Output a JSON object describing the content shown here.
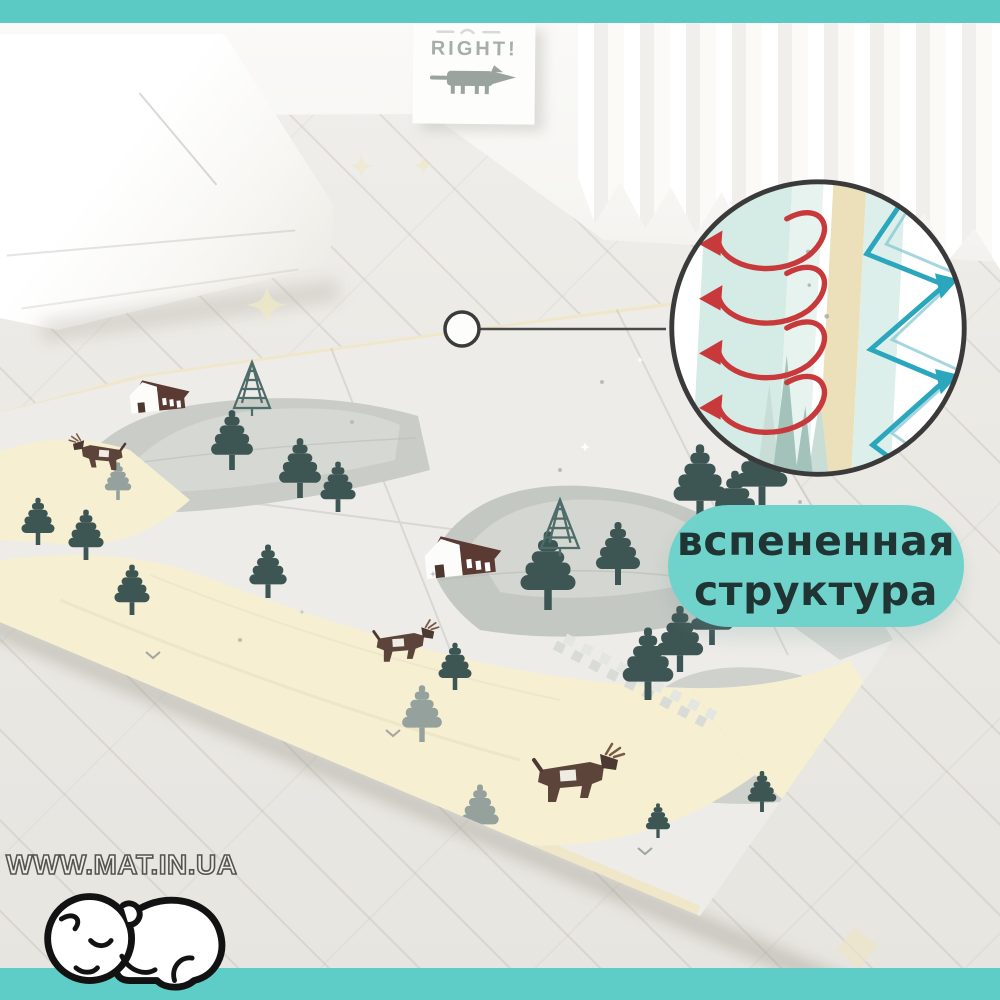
{
  "image": {
    "type": "product-photo",
    "subject": "foldable baby play mat with forest print in a white room"
  },
  "top_strip": {
    "color": "#5bc9c4"
  },
  "bottom_strip": {
    "color": "#5ecdc7"
  },
  "poster": {
    "title": "RIGHT!",
    "title_color": "#a6adaa"
  },
  "callout": {
    "badge_line1": "вспененная",
    "badge_line2": "структура",
    "badge_bg": "#6fd2cb",
    "badge_text_color": "#1f3433",
    "circle_border_color": "#3a3a3a",
    "spring_color": "#c8393b",
    "zigzag_color": "#2aa6bd",
    "foam_band_teal": "#d5ebe6",
    "foam_band_cream": "#ece0ba"
  },
  "watermark": {
    "text": "WWW.MAT.IN.UA"
  },
  "mat": {
    "base_color": "#edece8",
    "path_color": "#f6efd2",
    "mountain_color": "#c7cac5",
    "tree_color": "#3d5654",
    "grey_tree_color": "#95a19d",
    "deer_color": "#5c443a",
    "house_roof_color": "#5a3a32"
  },
  "icons": {
    "baby_logo": "sleeping-baby-icon",
    "poster_animal": "fox-illustration",
    "spring": "foam-spring-arrows-icon",
    "zigzag": "foam-zigzag-arrows-icon",
    "callout_dot": "callout-dot",
    "stars": "star-decoration"
  }
}
